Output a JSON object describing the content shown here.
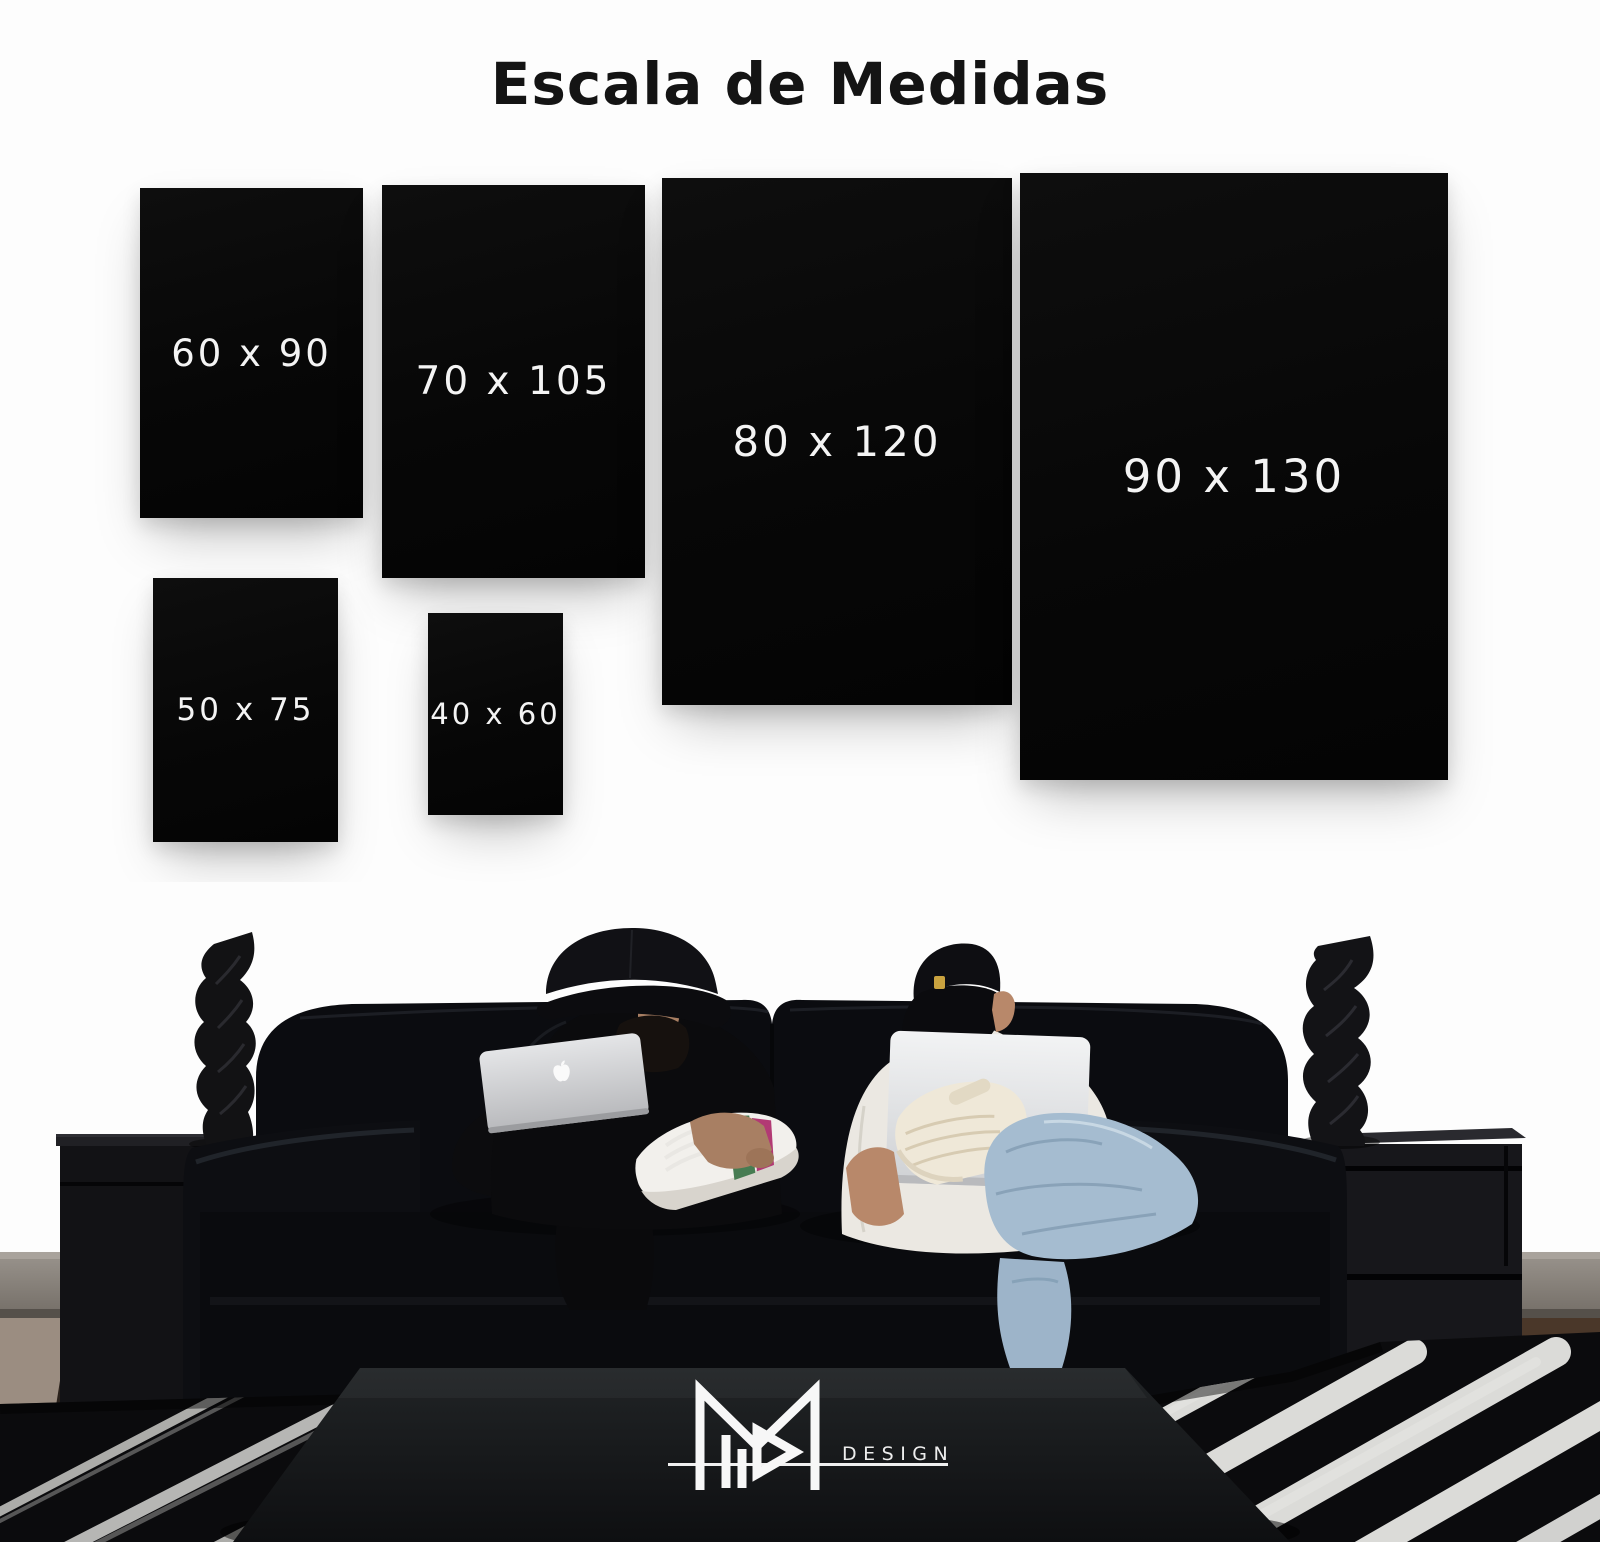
{
  "title": "Escala de Medidas",
  "size_boxes": [
    {
      "id": "60x90",
      "label": "60 x 90"
    },
    {
      "id": "70x105",
      "label": "70 x 105"
    },
    {
      "id": "80x120",
      "label": "80 x 120"
    },
    {
      "id": "90x130",
      "label": "90 x 130"
    },
    {
      "id": "50x75",
      "label": "50 x 75"
    },
    {
      "id": "40x60",
      "label": "40 x 60"
    }
  ],
  "brand": {
    "wordmark": "DESIGN",
    "monogram_icon": "m-monogram-icon"
  },
  "icons": {
    "laptop_lid_logo": "apple-logo-icon"
  },
  "colors": {
    "background": "#fdfdfd",
    "poster_black": "#0a0a0a",
    "poster_label": "#f4f4f4",
    "title_text": "#141414",
    "logo_white": "#f5f5f5",
    "denim_blue": "#a5bcd0",
    "baseboard_gray": "#8e8881"
  }
}
